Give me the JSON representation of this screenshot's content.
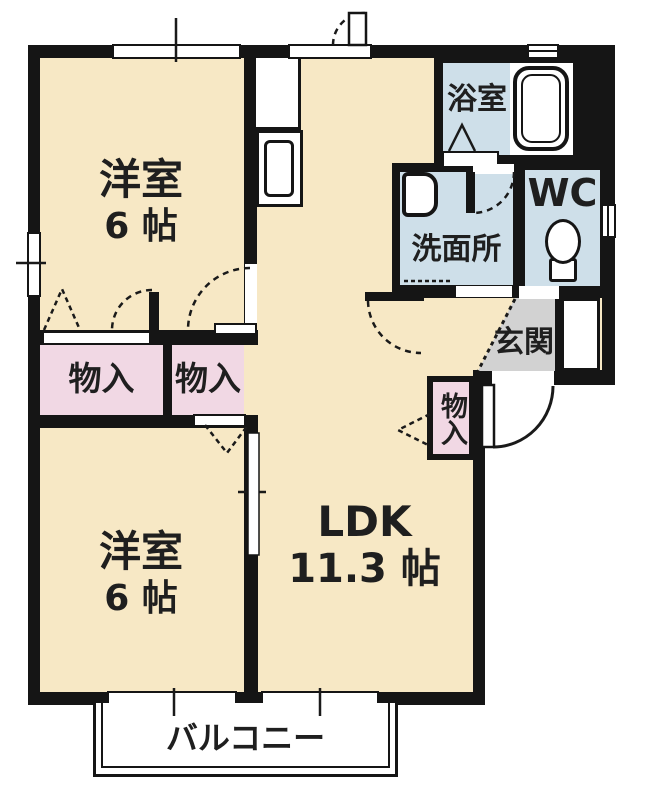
{
  "colors": {
    "wall": "#151515",
    "floor_fill": "#f7e8c5",
    "closet_fill": "#f1d8e4",
    "wet_area_fill": "#cedfe9",
    "entrance_fill": "#d2d2d2",
    "text": "#1f1f1f",
    "background": "#ffffff"
  },
  "rooms": {
    "bedroom_top": {
      "label": "洋室",
      "size": "6 帖"
    },
    "bedroom_bottom": {
      "label": "洋室",
      "size": "6 帖"
    },
    "ldk": {
      "label": "LDK",
      "size": "11.3 帖"
    },
    "bath": {
      "label": "浴室"
    },
    "washroom": {
      "label": "洗面所"
    },
    "toilet": {
      "label": "WC"
    },
    "entrance": {
      "label": "玄関"
    },
    "balcony": {
      "label": "バルコニー"
    },
    "closet_top_left": {
      "label": "物入"
    },
    "closet_top_right": {
      "label": "物入"
    },
    "closet_ldk": {
      "label": "物入"
    }
  }
}
